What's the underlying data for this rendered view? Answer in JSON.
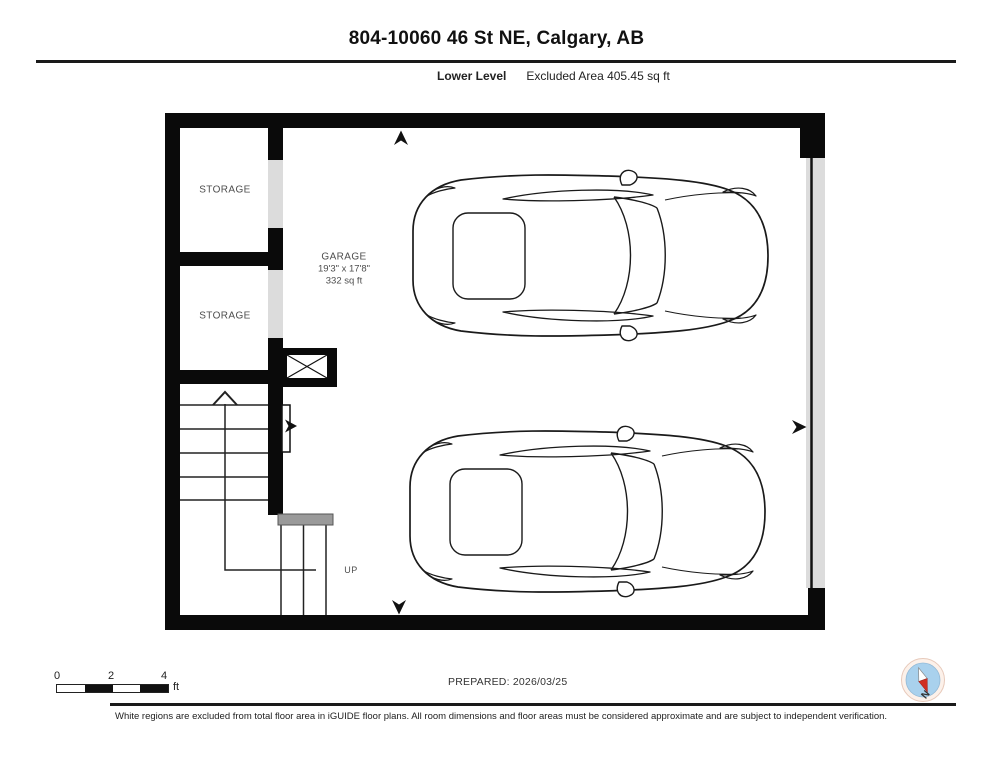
{
  "header": {
    "title": "804-10060 46 St NE, Calgary, AB",
    "level_label": "Lower Level",
    "excluded_area": "Excluded Area 405.45 sq ft"
  },
  "floorplan": {
    "rooms": [
      {
        "name": "storage-1",
        "label": "STORAGE"
      },
      {
        "name": "storage-2",
        "label": "STORAGE"
      },
      {
        "name": "garage",
        "label": "GARAGE",
        "dimensions": "19'3\" x 17'8\"",
        "area": "332 sq ft"
      }
    ],
    "stair_up_label": "UP"
  },
  "footer": {
    "scale": {
      "ticks": [
        "0",
        "2",
        "4"
      ],
      "unit": "ft"
    },
    "prepared": "PREPARED: 2026/03/25",
    "compass_north_label": "N",
    "disclaimer": "White regions are excluded from total floor area in iGUIDE floor plans. All room dimensions and floor areas must be considered approximate and are subject to independent verification."
  },
  "colors": {
    "wall": "#0a0a0a",
    "door_gap": "#dcdcdc",
    "landing": "#9a9a9a",
    "compass_fill": "#a9d1ed",
    "compass_needle_red": "#d02f23"
  }
}
